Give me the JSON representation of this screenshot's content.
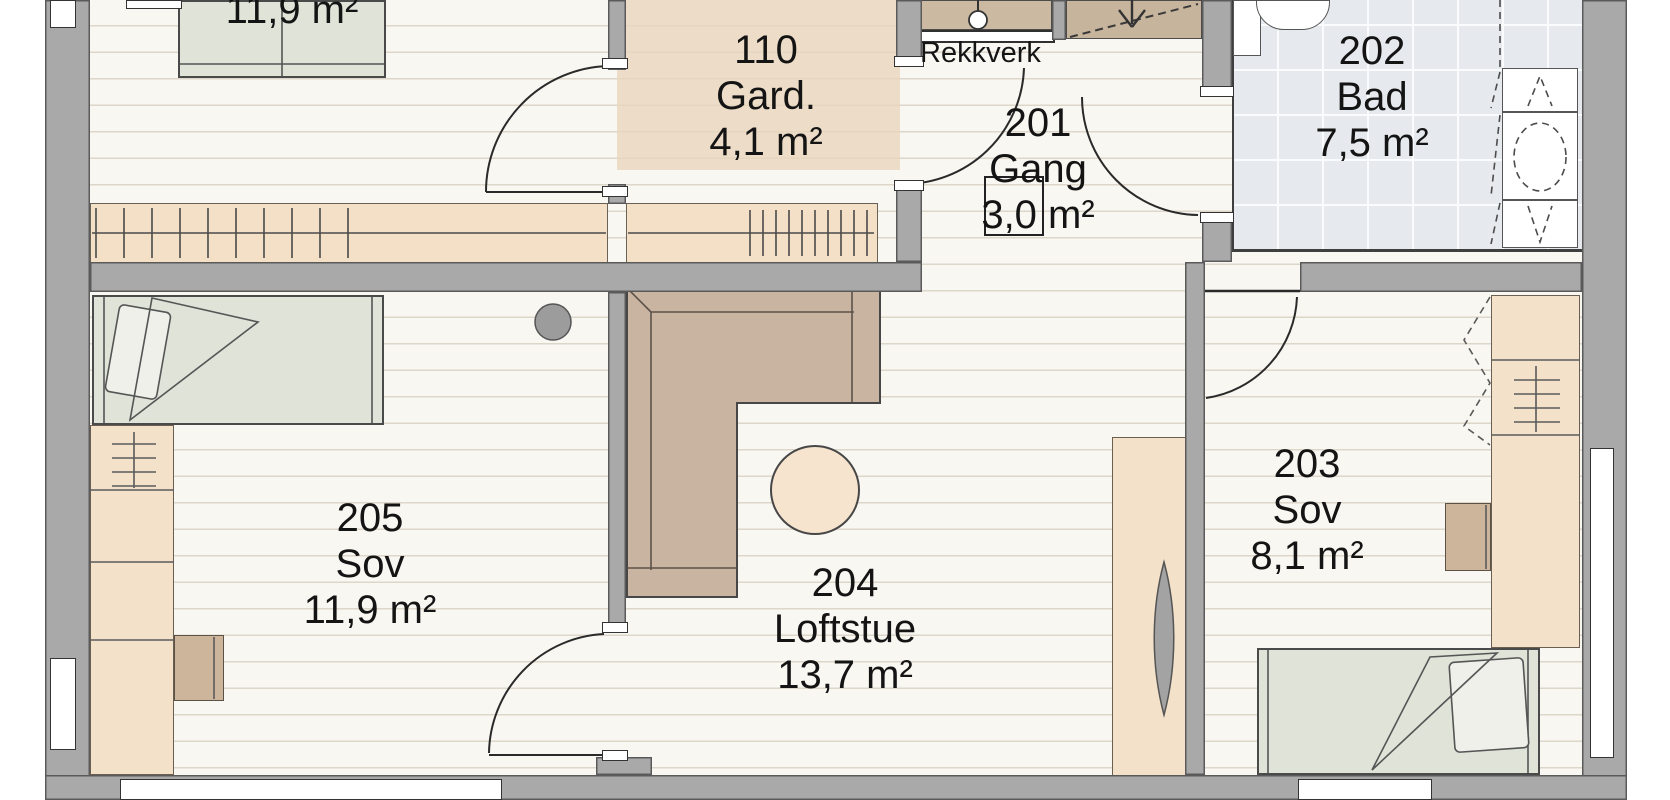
{
  "plan_title": "Upper floor plan",
  "labels": {
    "railing": "Rekkverk"
  },
  "rooms": [
    {
      "number": "110",
      "name": "Gard.",
      "area": "4,1 m²"
    },
    {
      "number": "201",
      "name": "Gang",
      "area": "3,0 m²"
    },
    {
      "number": "202",
      "name": "Bad",
      "area": "7,5 m²"
    },
    {
      "number": "203",
      "name": "Sov",
      "area": "8,1 m²"
    },
    {
      "number": "204",
      "name": "Loftstue",
      "area": "13,7 m²"
    },
    {
      "number": "205",
      "name": "Sov",
      "area": "11,9 m²"
    }
  ],
  "cut_room": {
    "area": "11,9 m²"
  },
  "furniture": [
    "double-bed",
    "single-bed",
    "corner-sofa",
    "round-table",
    "stool",
    "wardrobe",
    "dresser",
    "desk",
    "tall-cabinet",
    "vanity",
    "sink",
    "toilet",
    "staircase",
    "railing"
  ],
  "colors": {
    "wall": "#a9a9a9",
    "floor_plank": "#f9f7f2",
    "plank_line": "#ddd7c9",
    "wardrobe_tan": "#f3e1c9",
    "shade_tan": "#e9d6bc",
    "sofa": "#c9b4a2",
    "table": "#f6e4ce",
    "mattress": "#dfe3d8",
    "bath_tile": "#e6e9ed",
    "text": "#141414"
  }
}
